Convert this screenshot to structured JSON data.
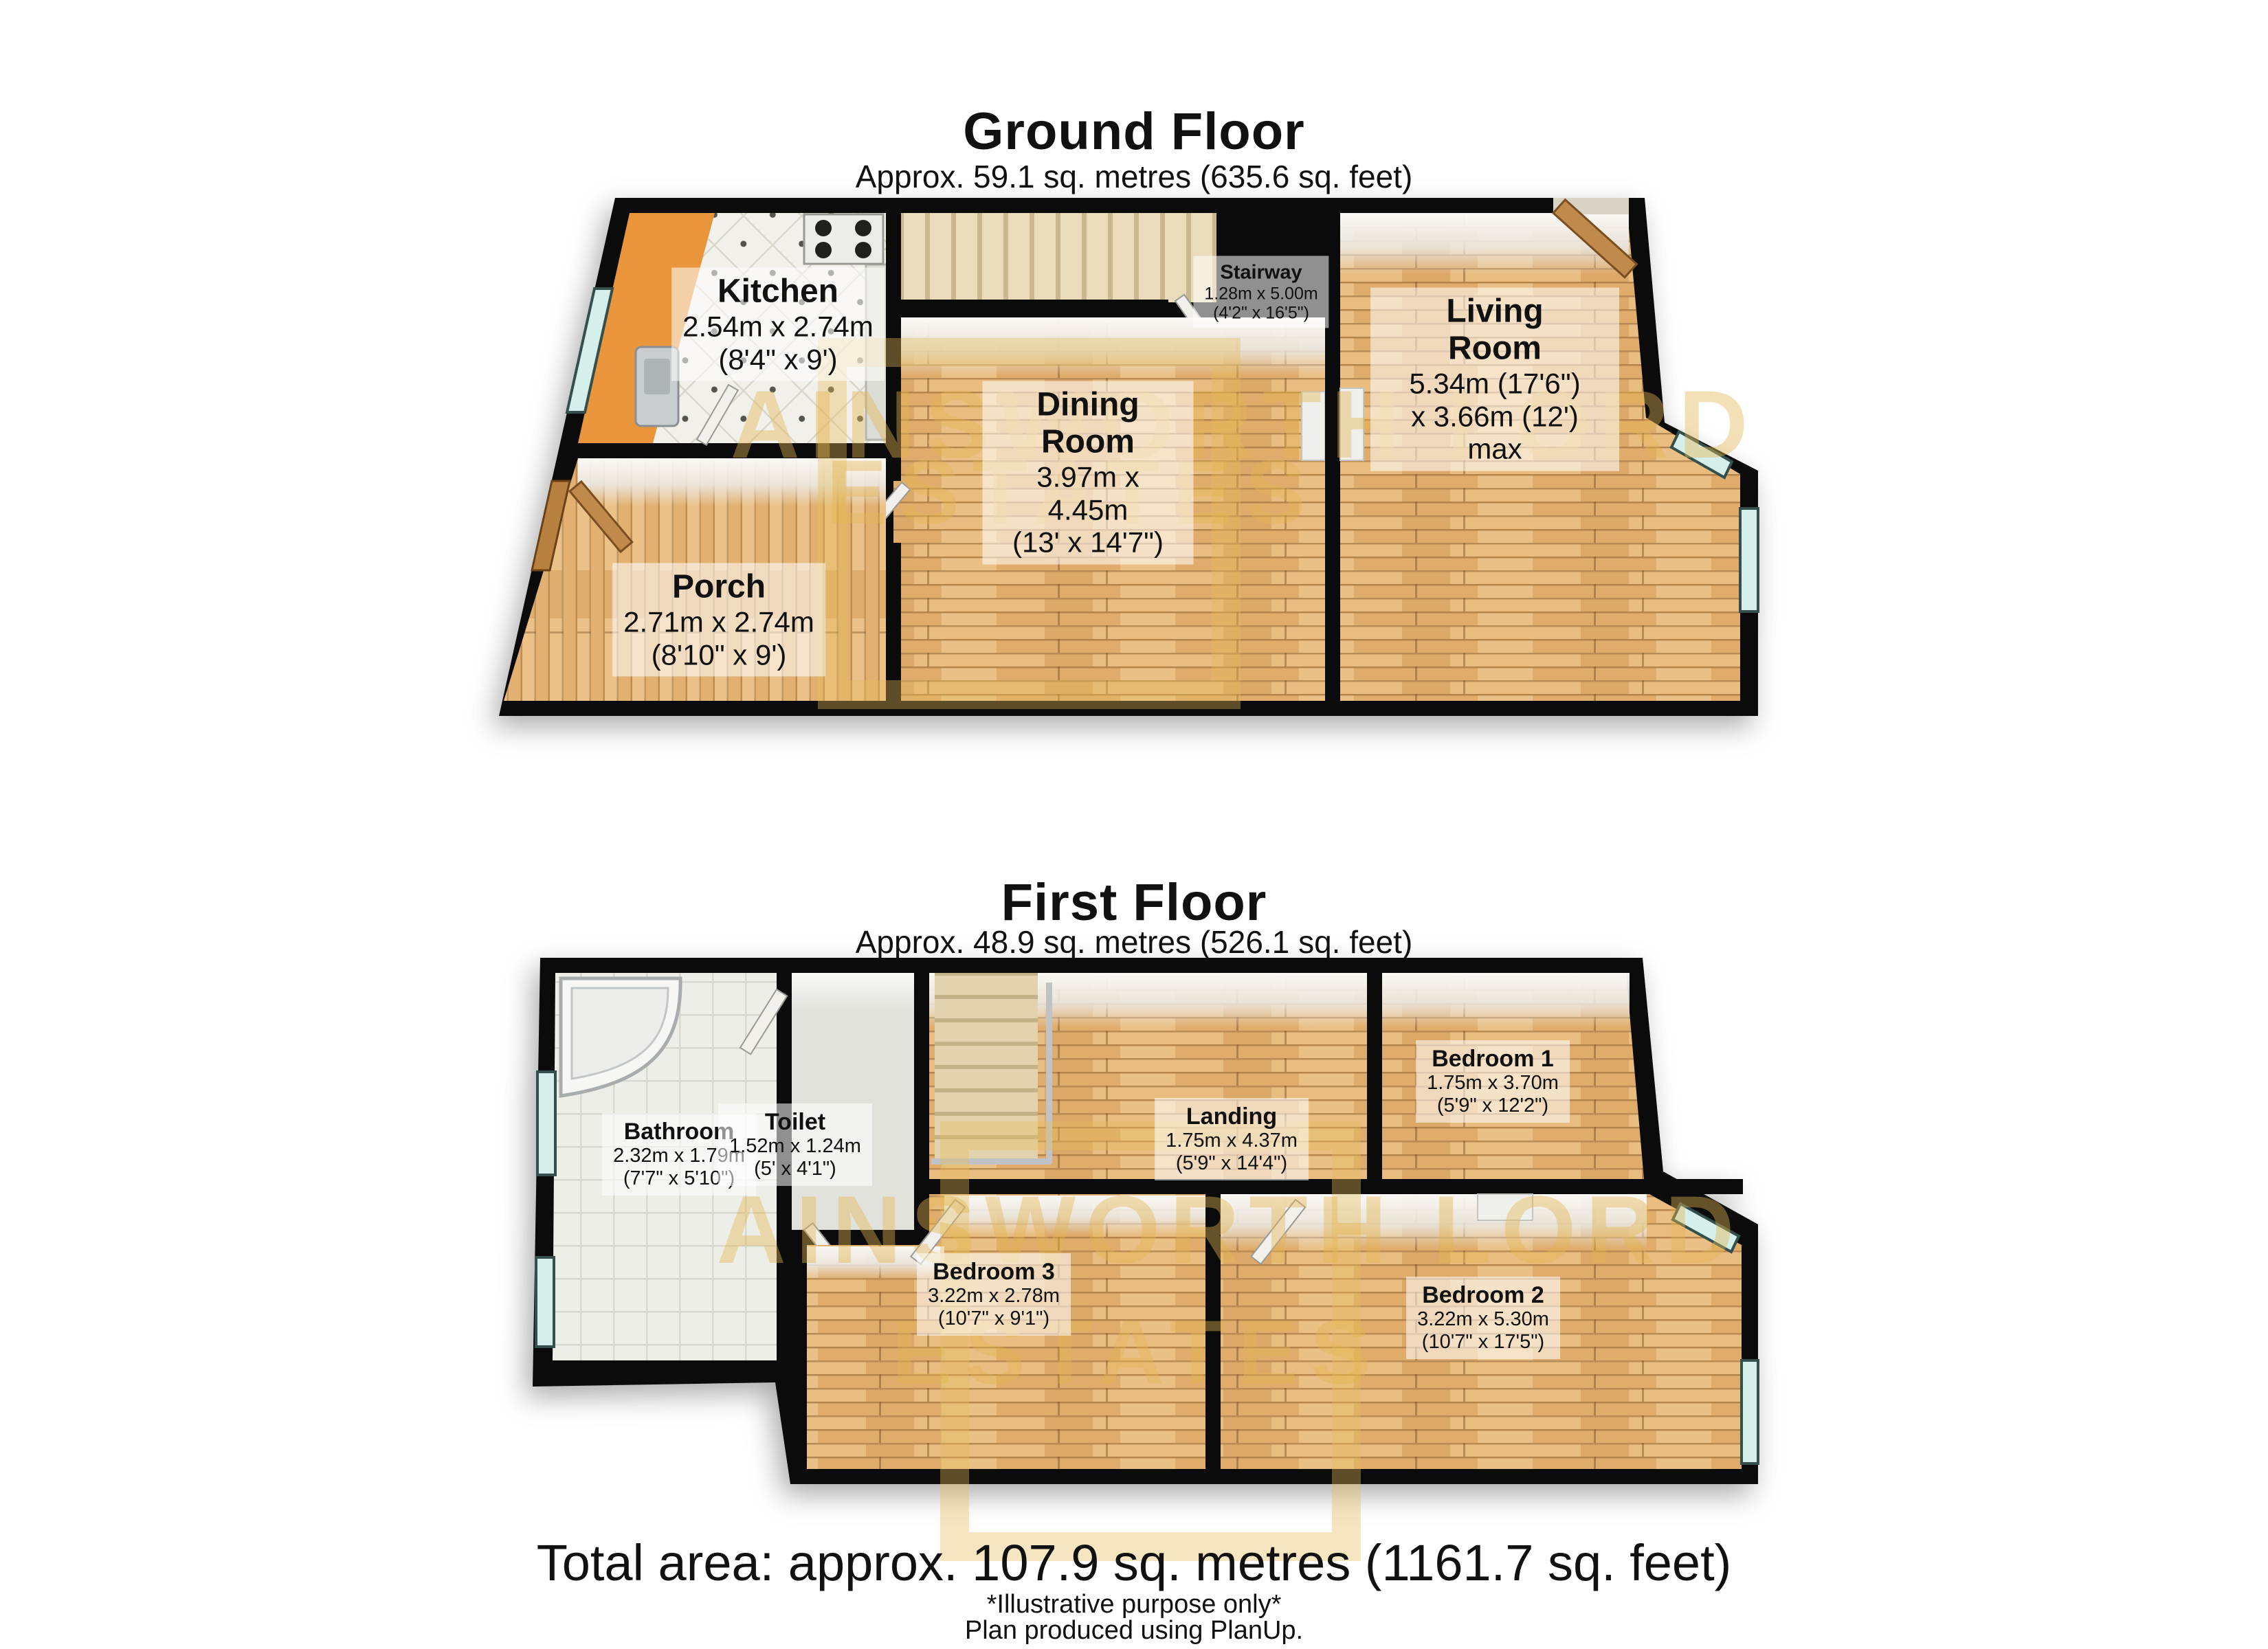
{
  "ground_floor": {
    "title": "Ground Floor",
    "subtitle": "Approx. 59.1 sq. metres (635.6 sq. feet)",
    "rooms": {
      "kitchen": {
        "name": "Kitchen",
        "dim1": "2.54m x 2.74m",
        "dim2": "(8'4\" x 9')"
      },
      "stairway": {
        "name": "Stairway",
        "dim1": "1.28m x 5.00m",
        "dim2": "(4'2\" x 16'5\")"
      },
      "dining": {
        "name": "Dining Room",
        "dim1": "3.97m x 4.45m",
        "dim2": "(13' x 14'7\")"
      },
      "living": {
        "name": "Living Room",
        "dim1": "5.34m (17'6\")",
        "dim2": "x 3.66m (12') max"
      },
      "porch": {
        "name": "Porch",
        "dim1": "2.71m x 2.74m",
        "dim2": "(8'10\" x 9')"
      }
    }
  },
  "first_floor": {
    "title": "First Floor",
    "subtitle": "Approx. 48.9 sq. metres (526.1 sq. feet)",
    "rooms": {
      "bathroom": {
        "name": "Bathroom",
        "dim1": "2.32m x 1.79m",
        "dim2": "(7'7\" x 5'10\")"
      },
      "toilet": {
        "name": "Toilet",
        "dim1": "1.52m x 1.24m",
        "dim2": "(5' x 4'1\")"
      },
      "landing": {
        "name": "Landing",
        "dim1": "1.75m x 4.37m",
        "dim2": "(5'9\" x 14'4\")"
      },
      "bedroom1": {
        "name": "Bedroom 1",
        "dim1": "1.75m x 3.70m",
        "dim2": "(5'9\" x 12'2\")"
      },
      "bedroom2": {
        "name": "Bedroom 2",
        "dim1": "3.22m x 5.30m",
        "dim2": "(10'7\" x 17'5\")"
      },
      "bedroom3": {
        "name": "Bedroom 3",
        "dim1": "3.22m x 2.78m",
        "dim2": "(10'7\" x 9'1\")"
      }
    }
  },
  "footer": {
    "total_area": "Total area: approx. 107.9 sq. metres (1161.7 sq. feet)",
    "note1": "*Illustrative purpose only*",
    "note2": "Plan produced using PlanUp."
  },
  "watermark": {
    "line1": "AINSWORTH LORD",
    "line2": "ESTATES"
  },
  "colors": {
    "wall": "#0b0b0b",
    "wood": "#DCA768",
    "kitchen_floor": "#E8953C",
    "window_glass": "#D5EFEA",
    "watermark_gold": "#E2B44C",
    "stairs": "#EADCBA"
  }
}
